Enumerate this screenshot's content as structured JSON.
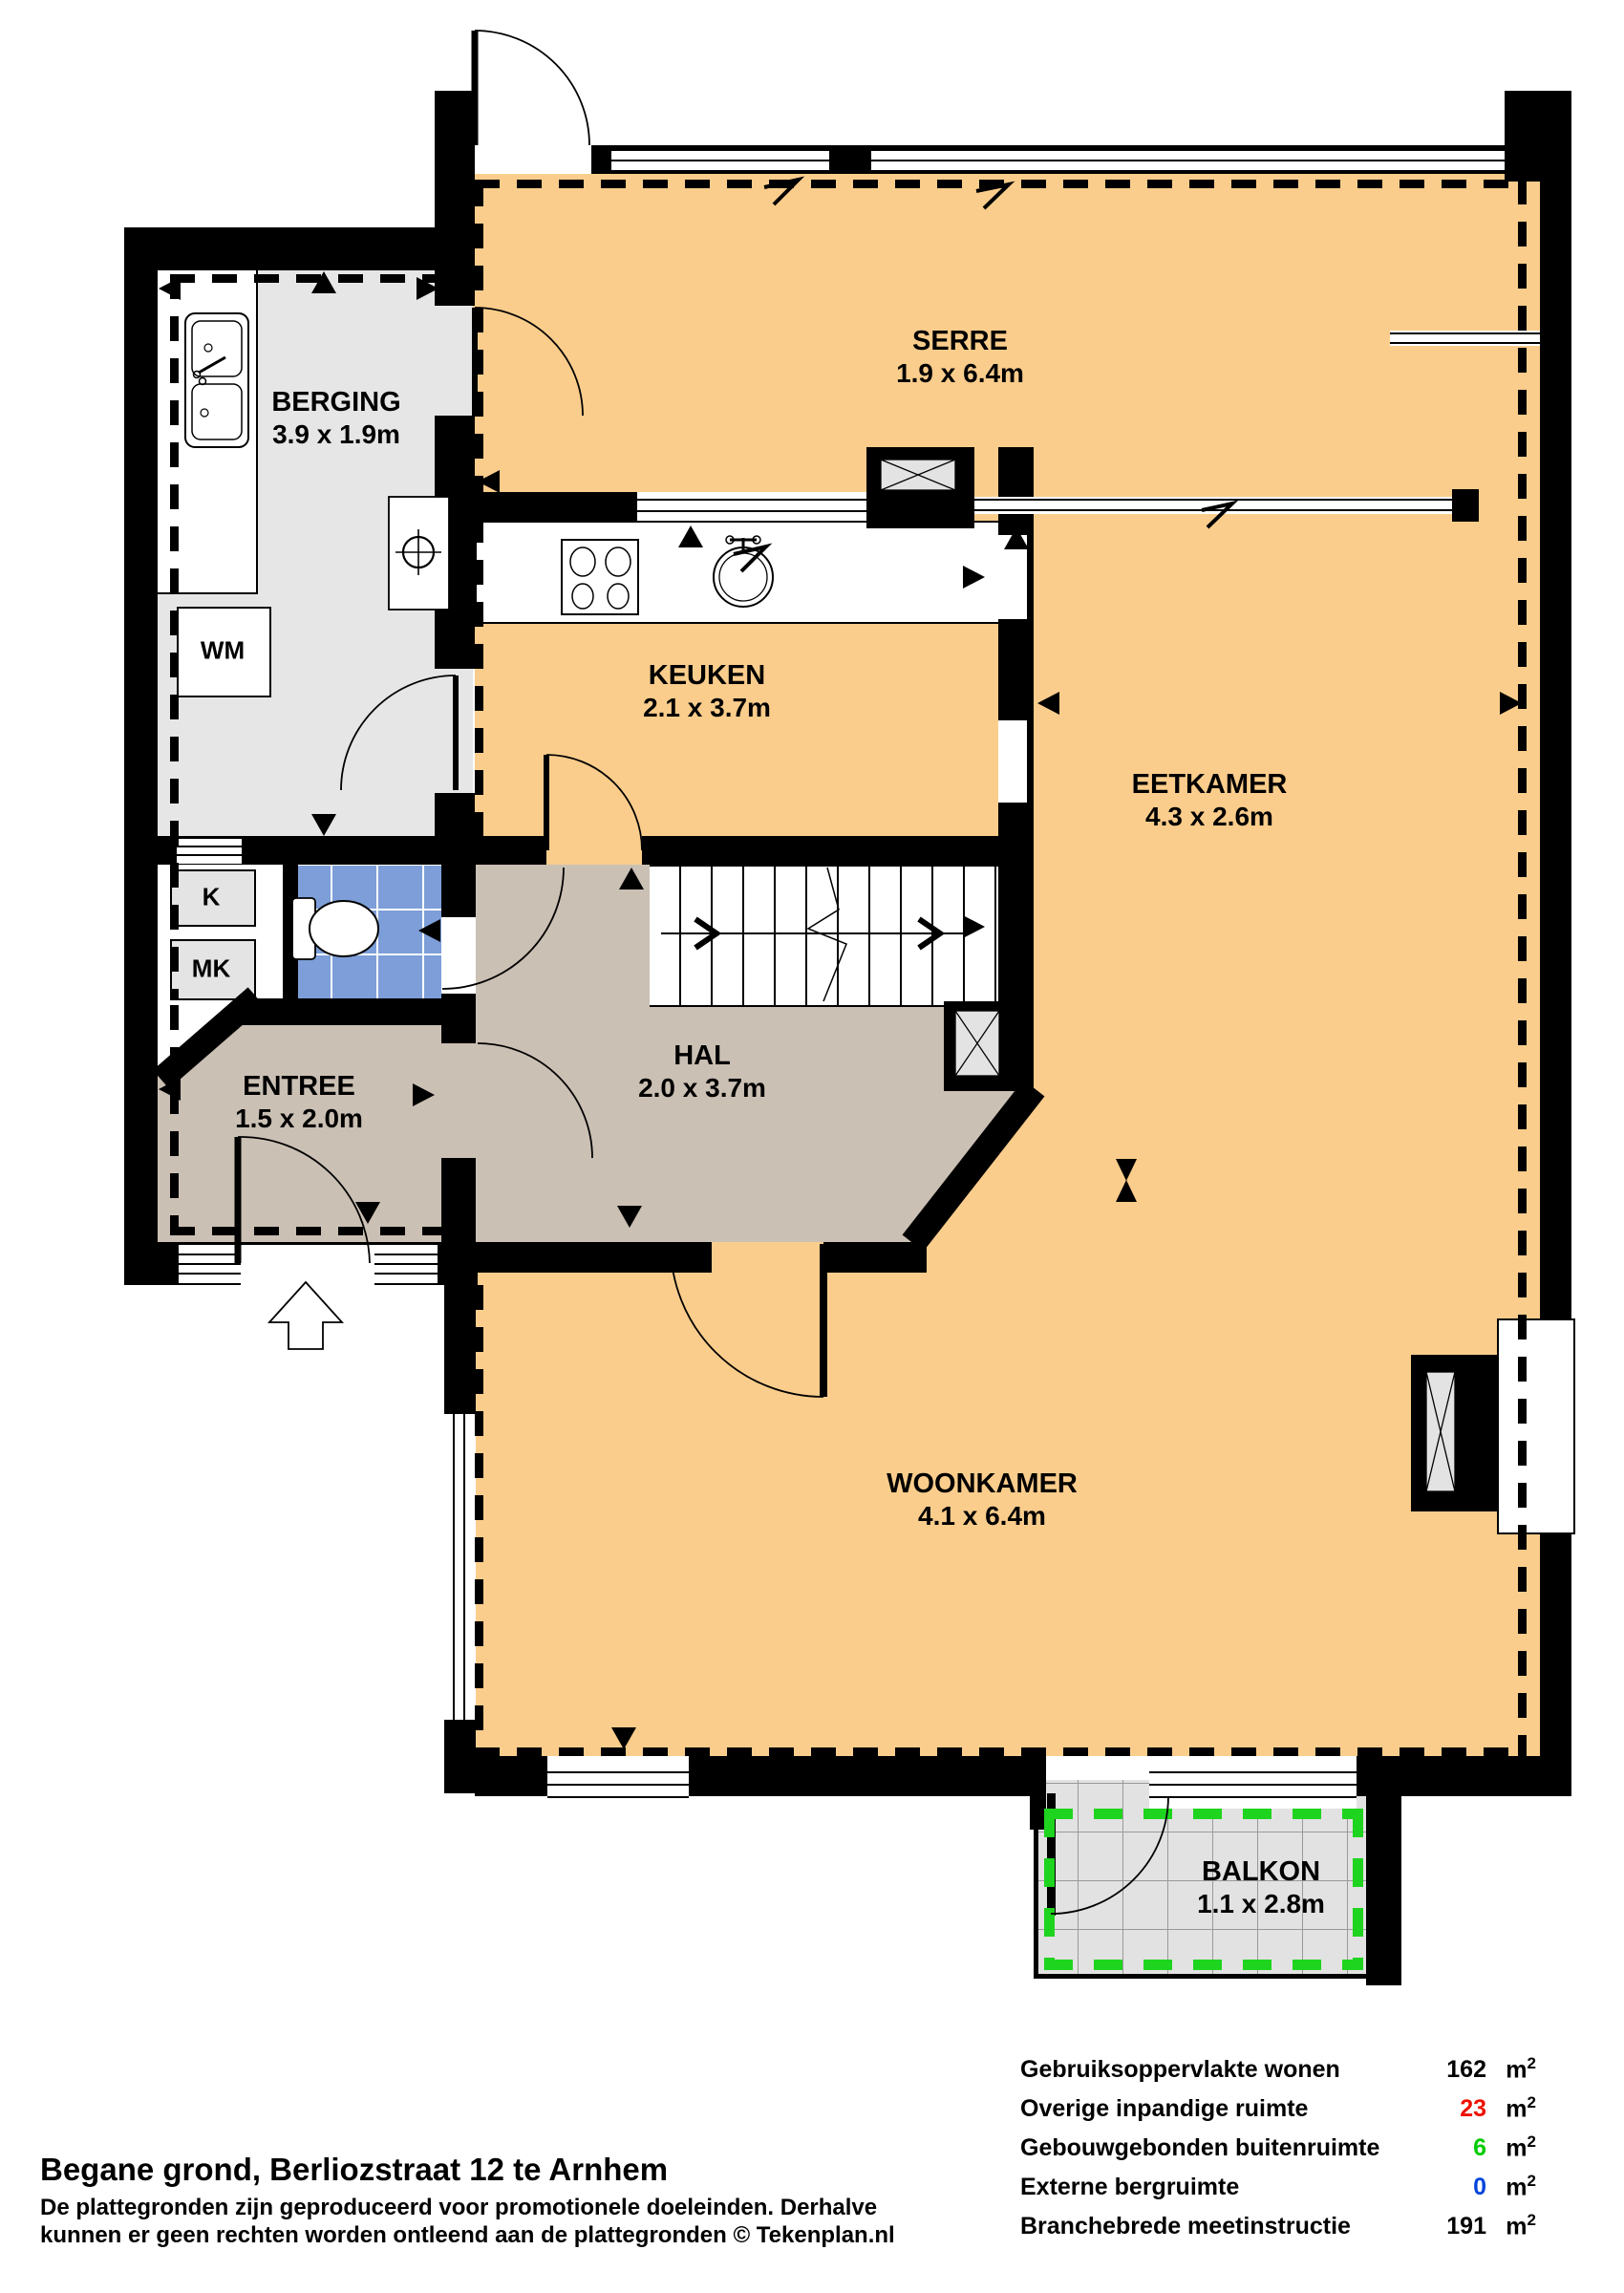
{
  "rooms": {
    "serre": {
      "name": "SERRE",
      "dims": "1.9 x 6.4m"
    },
    "berging": {
      "name": "BERGING",
      "dims": "3.9 x 1.9m"
    },
    "keuken": {
      "name": "KEUKEN",
      "dims": "2.1 x 3.7m"
    },
    "eetkamer": {
      "name": "EETKAMER",
      "dims": "4.3 x 2.6m"
    },
    "hal": {
      "name": "HAL",
      "dims": "2.0 x 3.7m"
    },
    "entree": {
      "name": "ENTREE",
      "dims": "1.5 x 2.0m"
    },
    "woonkamer": {
      "name": "WOONKAMER",
      "dims": "4.1 x 6.4m"
    },
    "balkon": {
      "name": "BALKON",
      "dims": "1.1 x 2.8m"
    }
  },
  "fixtures": {
    "washing_machine": "WM",
    "closet": "K",
    "meter_closet": "MK"
  },
  "legend": {
    "rows": [
      {
        "label": "Gebruiksoppervlakte wonen",
        "value": "162",
        "unit": "m",
        "sup": "2",
        "color": "#000000"
      },
      {
        "label": "Overige inpandige ruimte",
        "value": "23",
        "unit": "m",
        "sup": "2",
        "color": "#EE1100"
      },
      {
        "label": "Gebouwgebonden buitenruimte",
        "value": "6",
        "unit": "m",
        "sup": "2",
        "color": "#00CC00"
      },
      {
        "label": "Externe bergruimte",
        "value": "0",
        "unit": "m",
        "sup": "2",
        "color": "#0044DD"
      },
      {
        "label": "Branchebrede meetinstructie",
        "value": "191",
        "unit": "m",
        "sup": "2",
        "color": "#000000"
      }
    ]
  },
  "footer": {
    "title": "Begane grond, Berliozstraat 12 te Arnhem",
    "line1": "De plattegronden zijn geproduceerd voor promotionele doeleinden. Derhalve",
    "line2": "kunnen er geen rechten worden ontleend aan de plattegronden © Tekenplan.nl"
  },
  "colors": {
    "living_area": "#FBCD8C",
    "storage_area": "#E6E6E6",
    "hall_area": "#CBC0B4",
    "toilet_tiles": "#7D9ED8",
    "balcony_dash": "#1FD41F",
    "walls": "#000000"
  }
}
